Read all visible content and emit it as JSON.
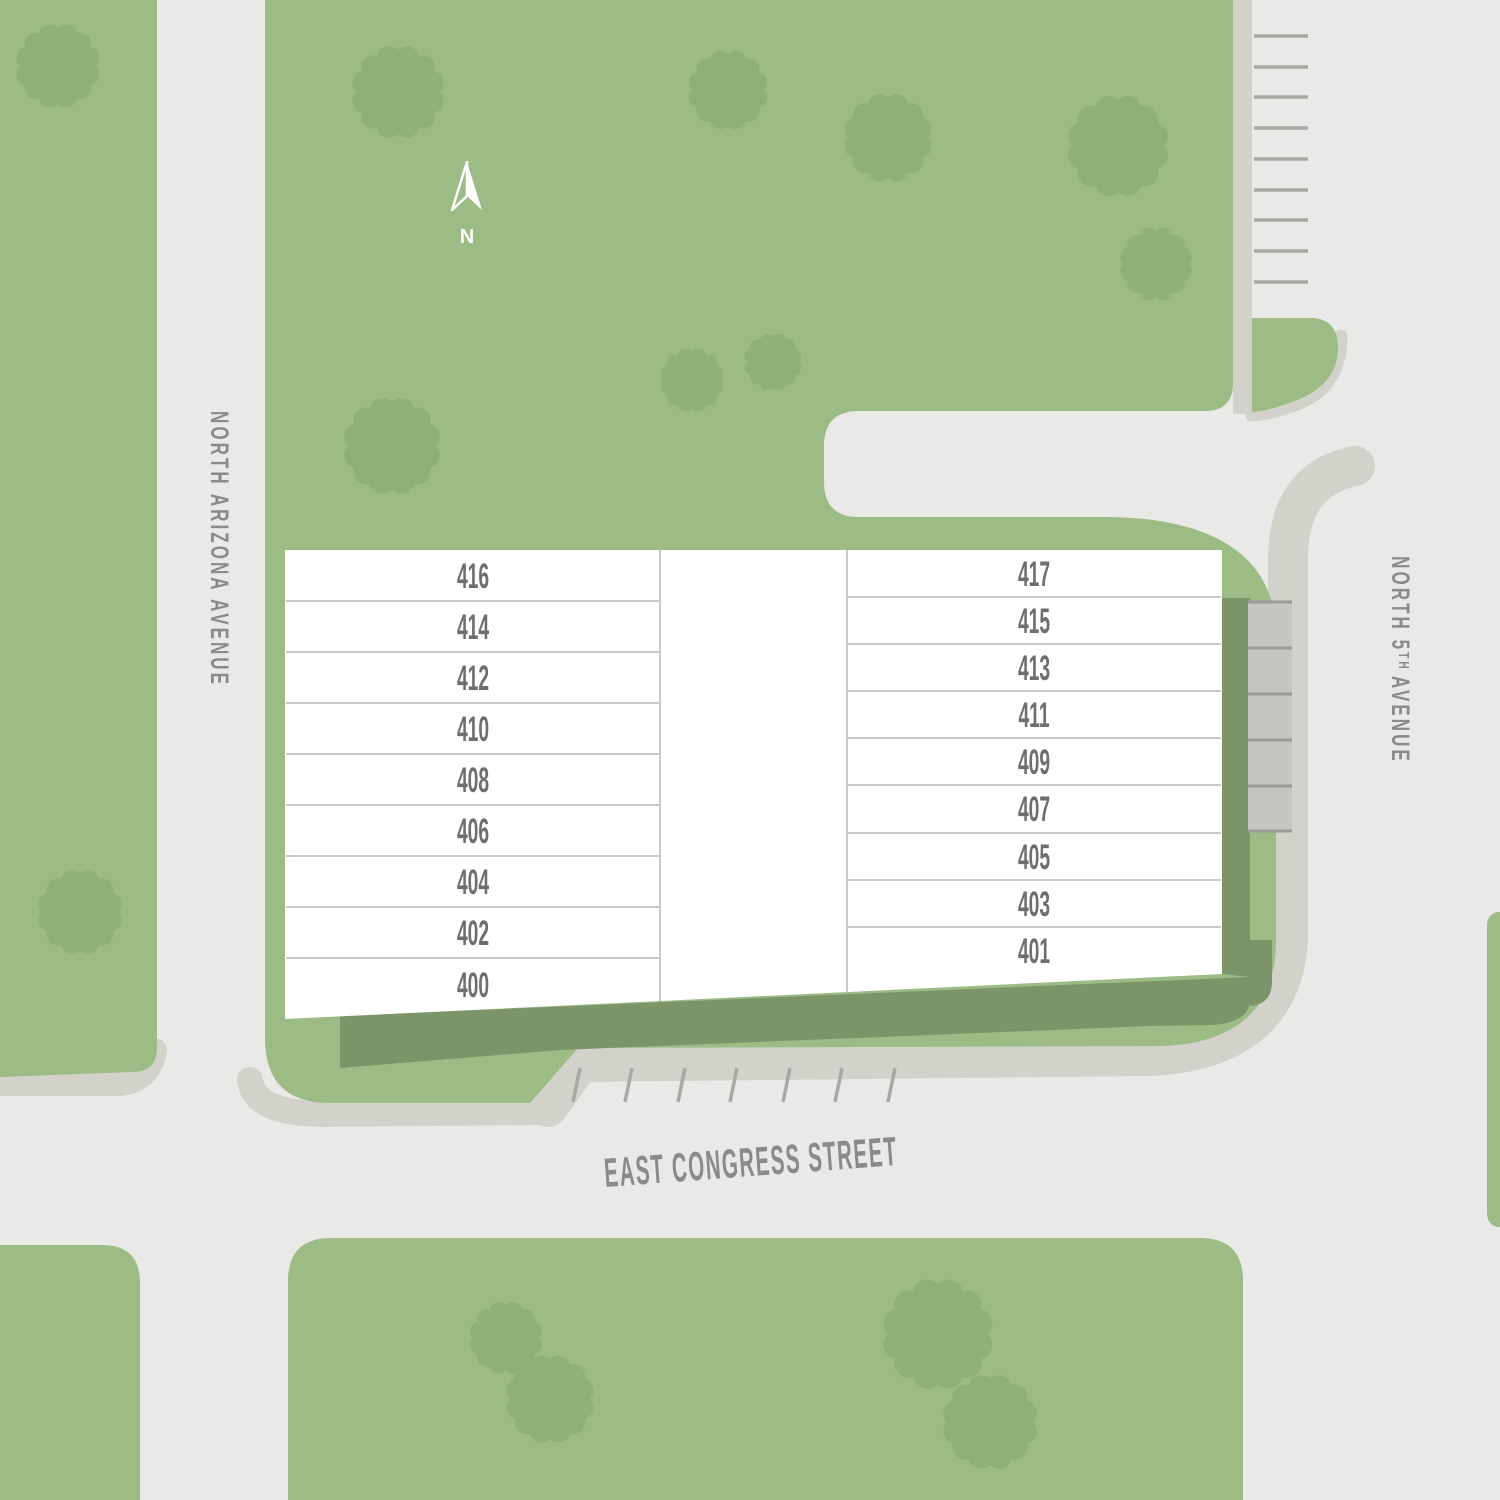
{
  "compass": {
    "label": "N"
  },
  "streets": {
    "north_arizona": "NORTH ARIZONA AVENUE",
    "east_congress": "EAST CONGRESS STREET",
    "north_5th": {
      "prefix": "NORTH 5",
      "sup": "TH",
      "suffix": "AVENUE"
    }
  },
  "building": {
    "left_units": [
      "416",
      "414",
      "412",
      "410",
      "408",
      "406",
      "404",
      "402",
      "400"
    ],
    "right_units": [
      "417",
      "415",
      "413",
      "411",
      "409",
      "407",
      "405",
      "403",
      "401"
    ]
  },
  "colors": {
    "road": "#e9eae8",
    "sidewalk": "#d2d2cb",
    "grass": "#9cbb85",
    "tree": "#90b07a",
    "dark_band": "#7b9468",
    "building": "#ffffff",
    "divider": "#c8c8c8",
    "unit_text": "#6e6e6e",
    "street_text": "#8a8a88",
    "park_line": "#a8a8a4",
    "park_strip": "#c6c6c1",
    "park_strip_line": "#9b9b97",
    "compass": "#ffffff"
  }
}
